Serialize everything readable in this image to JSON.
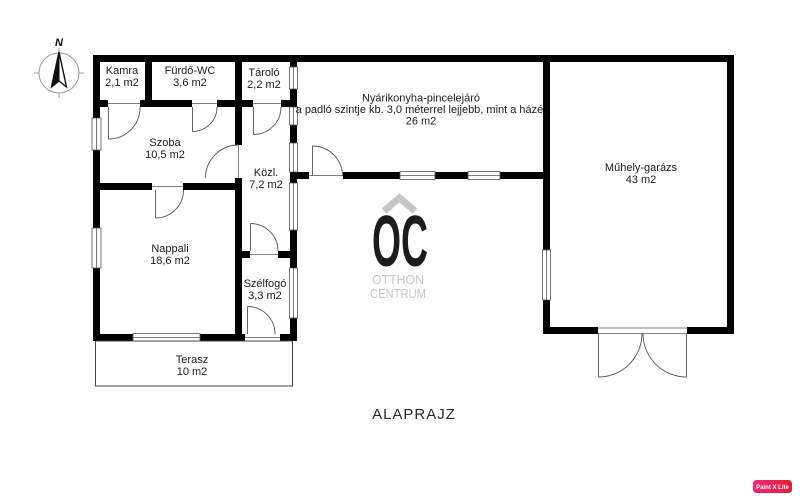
{
  "title": {
    "label": "ALAPRAJZ"
  },
  "compass": {
    "north_label": "N"
  },
  "watermark": {
    "logo_letters": "OC",
    "line1": "OTTHON",
    "line2": "CENTRUM",
    "color": "#c6c6c6"
  },
  "badge": {
    "label": "Paint X Lite",
    "color_left": "#ee2a7b",
    "color_right": "#e01e37"
  },
  "rooms": {
    "kamra": {
      "name": "Kamra",
      "area": "2,1 m2"
    },
    "furdo": {
      "name": "Fürdő-WC",
      "area": "3,6 m2"
    },
    "tarolo": {
      "name": "Tároló",
      "area": "2,2 m2"
    },
    "szoba": {
      "name": "Szoba",
      "area": "10,5 m2"
    },
    "kozl": {
      "name": "Közl.",
      "area": "7,2 m2"
    },
    "nyarikonyha": {
      "name": "Nyárikonyha-pincelejáró",
      "note": "a padló szintje kb. 3,0 méterrel lejjebb, mint a házé.",
      "area": "26 m2"
    },
    "muhely": {
      "name": "Műhely-garázs",
      "area": "43 m2"
    },
    "nappali": {
      "name": "Nappali",
      "area": "18,6 m2"
    },
    "szelfogo": {
      "name": "Szélfogó",
      "area": "3,3 m2"
    },
    "terasz": {
      "name": "Terasz",
      "area": "10 m2"
    }
  }
}
